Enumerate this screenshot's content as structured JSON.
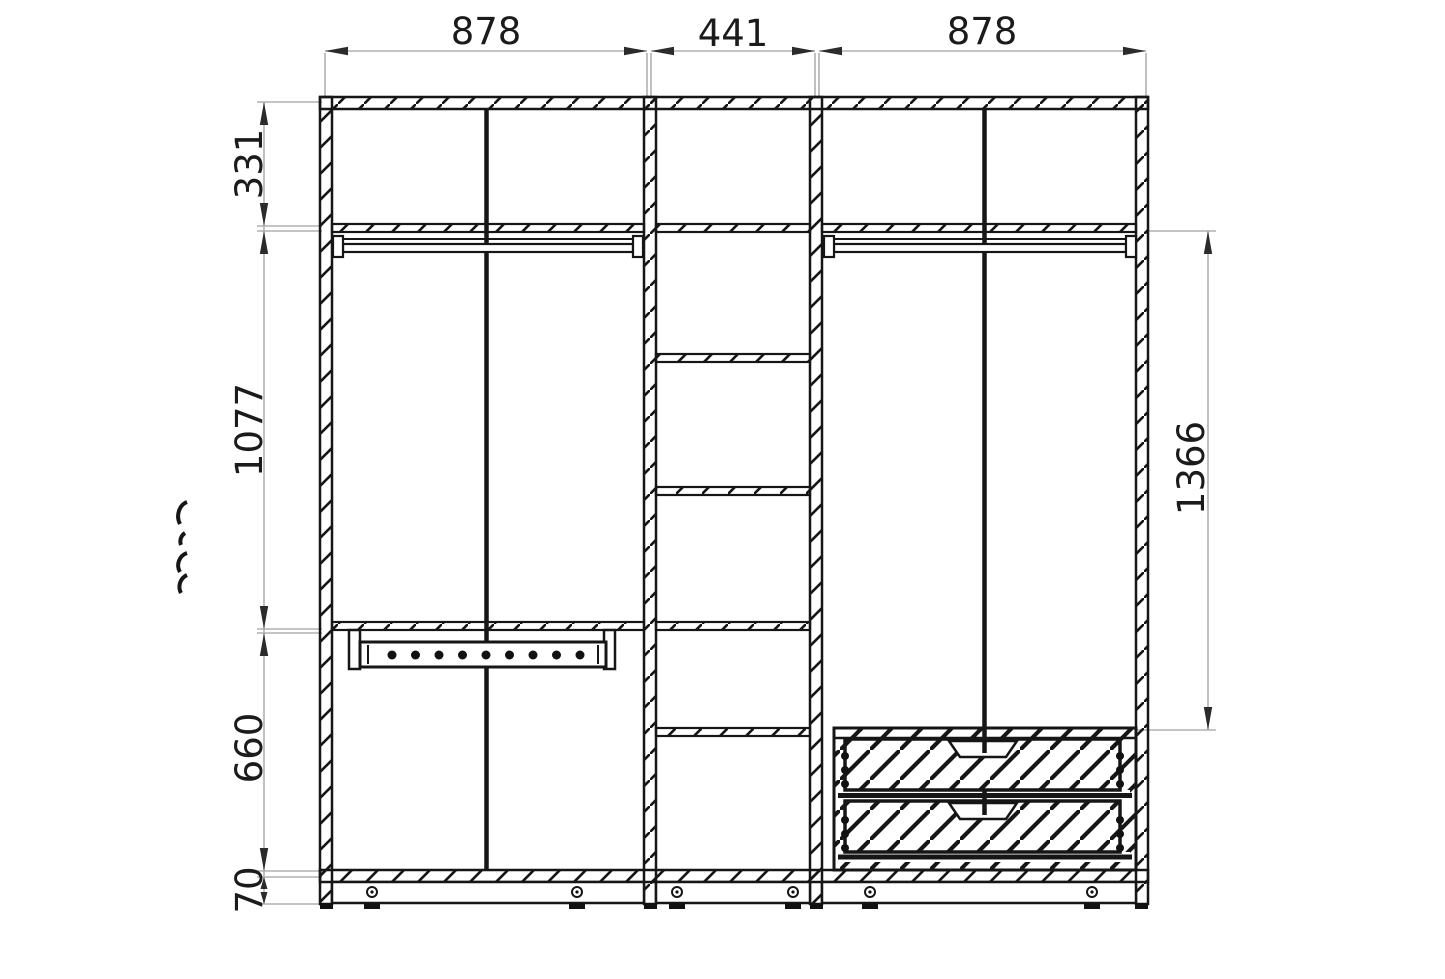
{
  "colors": {
    "line": "#161616",
    "dimension_line": "#b0b0b0",
    "arrow": "#2b2b2b",
    "background": "#ffffff"
  },
  "drawing": {
    "description": "wardrobe front section technical drawing with dimensions in mm",
    "dimensions": {
      "top": {
        "left_width": "878",
        "middle_width": "441",
        "right_width": "878"
      },
      "left": {
        "top_section": "331",
        "hanging_section": "1077",
        "lower_section": "660",
        "plinth": "70"
      },
      "right": {
        "interior_height": "1366"
      }
    }
  }
}
